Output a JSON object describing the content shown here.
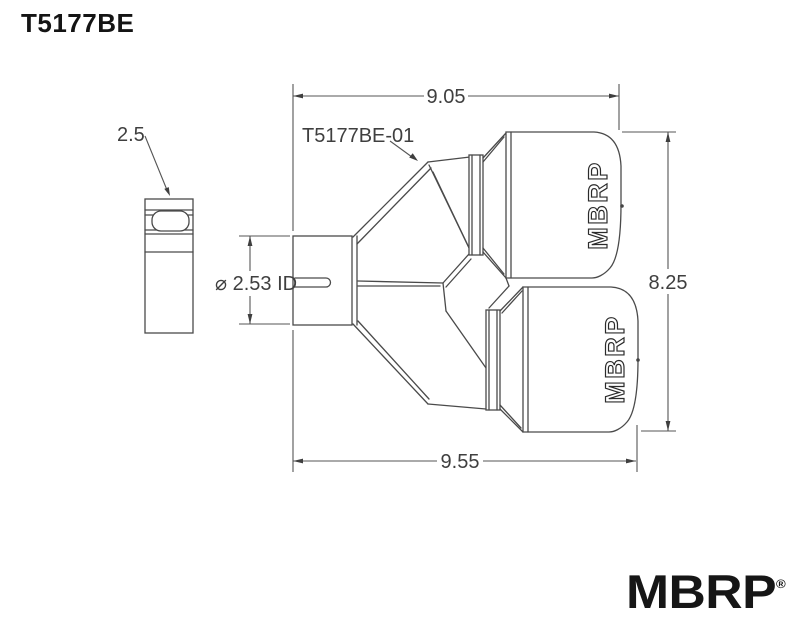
{
  "title": "T5177BE",
  "drawing": {
    "labels": {
      "clamp_width": "2.5",
      "part_number": "T5177BE-01",
      "inlet_diameter": "⌀ 2.53 ID",
      "dim_top": "9.05",
      "dim_right": "8.25",
      "dim_bottom": "9.55"
    },
    "tip_brand": "MBRP"
  },
  "logo": {
    "text": "MBRP",
    "registered": "®"
  },
  "colors": {
    "background": "#ffffff",
    "part_line": "#4a4a4a",
    "dimension_line": "#555555",
    "dimension_text": "#3f3f3f",
    "ink": "#141414"
  }
}
